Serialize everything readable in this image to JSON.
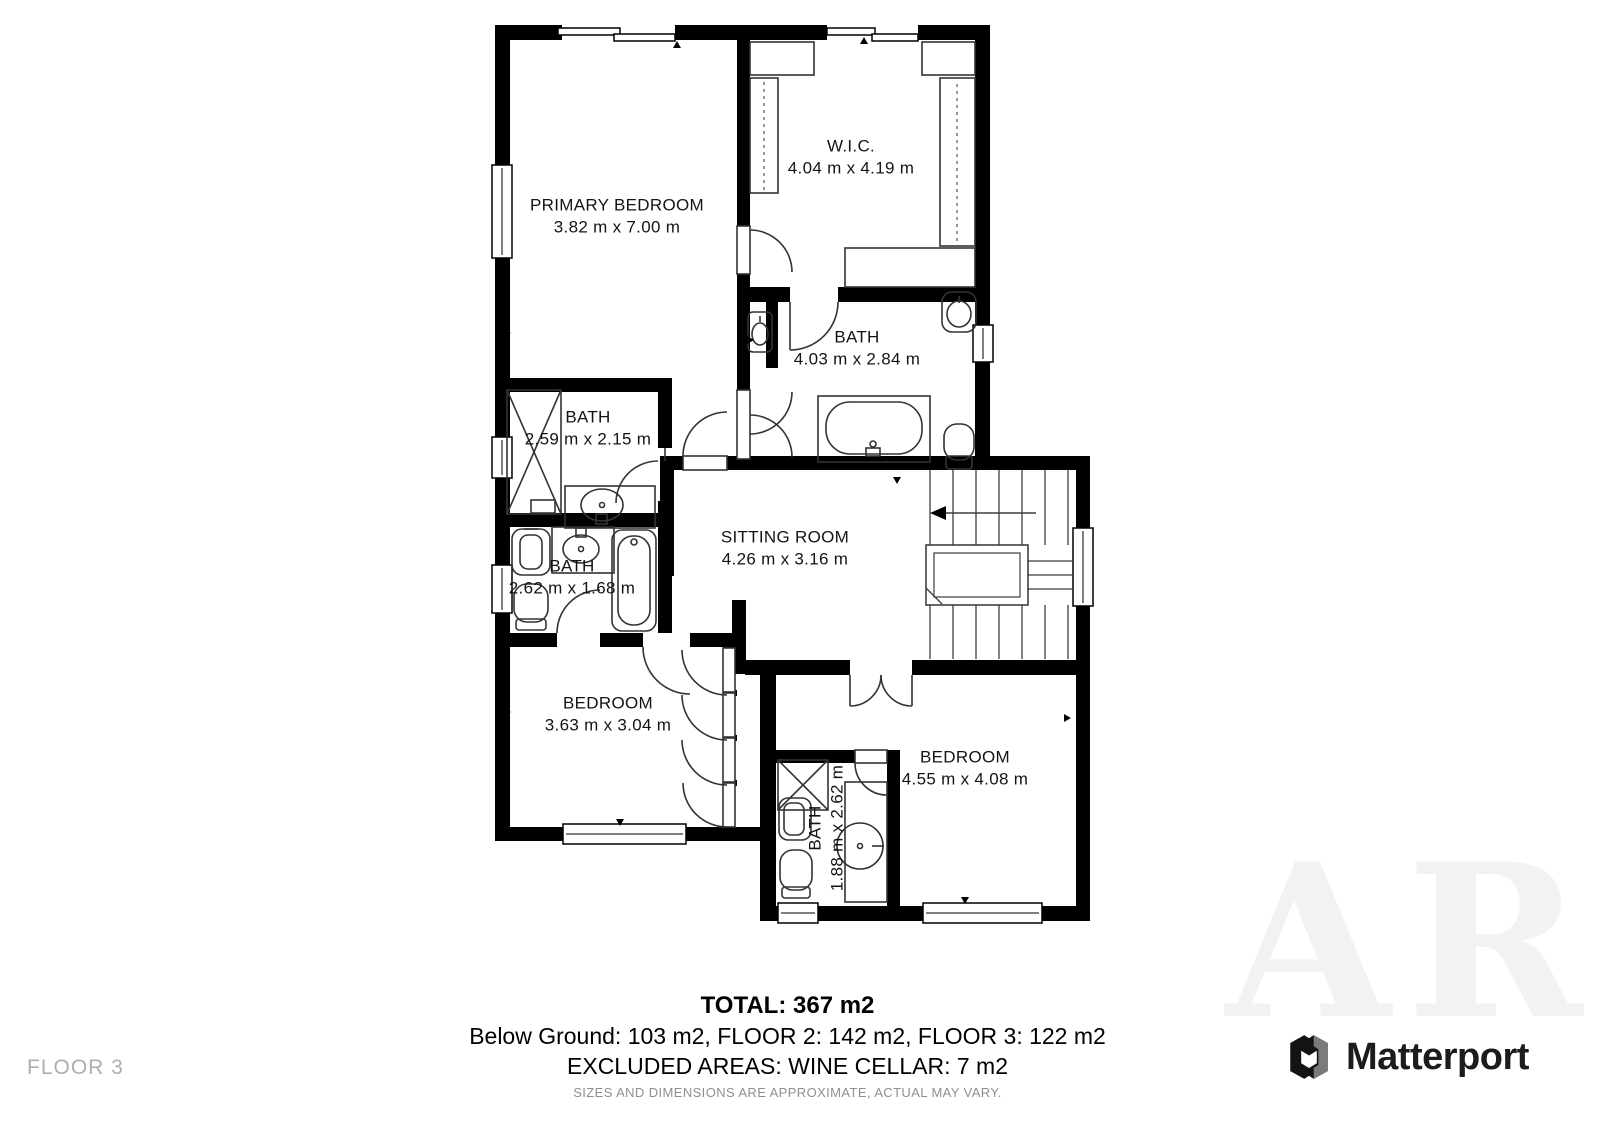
{
  "floor_plan": {
    "rooms": [
      {
        "name": "PRIMARY BEDROOM",
        "dims": "3.82 m x 7.00 m"
      },
      {
        "name": "W.I.C.",
        "dims": "4.04 m x 4.19 m"
      },
      {
        "name": "BATH",
        "dims": "4.03 m x 2.84 m"
      },
      {
        "name": "BATH",
        "dims": "2.59 m x 2.15 m"
      },
      {
        "name": "BATH",
        "dims": "2.62 m x 1.68 m"
      },
      {
        "name": "SITTING ROOM",
        "dims": "4.26 m x 3.16 m"
      },
      {
        "name": "BEDROOM",
        "dims": "3.63 m x 3.04 m"
      },
      {
        "name": "BEDROOM",
        "dims": "4.55 m x 4.08 m"
      },
      {
        "name": "BATH",
        "dims": "1.88 m x 2.62 m"
      }
    ]
  },
  "summary": {
    "total": "TOTAL: 367 m2",
    "floors": "Below Ground: 103 m2, FLOOR 2: 142 m2, FLOOR 3: 122 m2",
    "excluded": "EXCLUDED AREAS: WINE CELLAR: 7 m2",
    "disclaimer": "SIZES AND DIMENSIONS ARE APPROXIMATE, ACTUAL MAY VARY."
  },
  "footer": {
    "floor_label": "FLOOR 3",
    "brand": "Matterport"
  },
  "watermark": "ARE",
  "colors": {
    "wall": "#000000",
    "fixture_line": "#333333",
    "muted_text": "#8f8f8f",
    "floor_label_text": "#aeaeae",
    "brand_text": "#1c1c1c"
  }
}
